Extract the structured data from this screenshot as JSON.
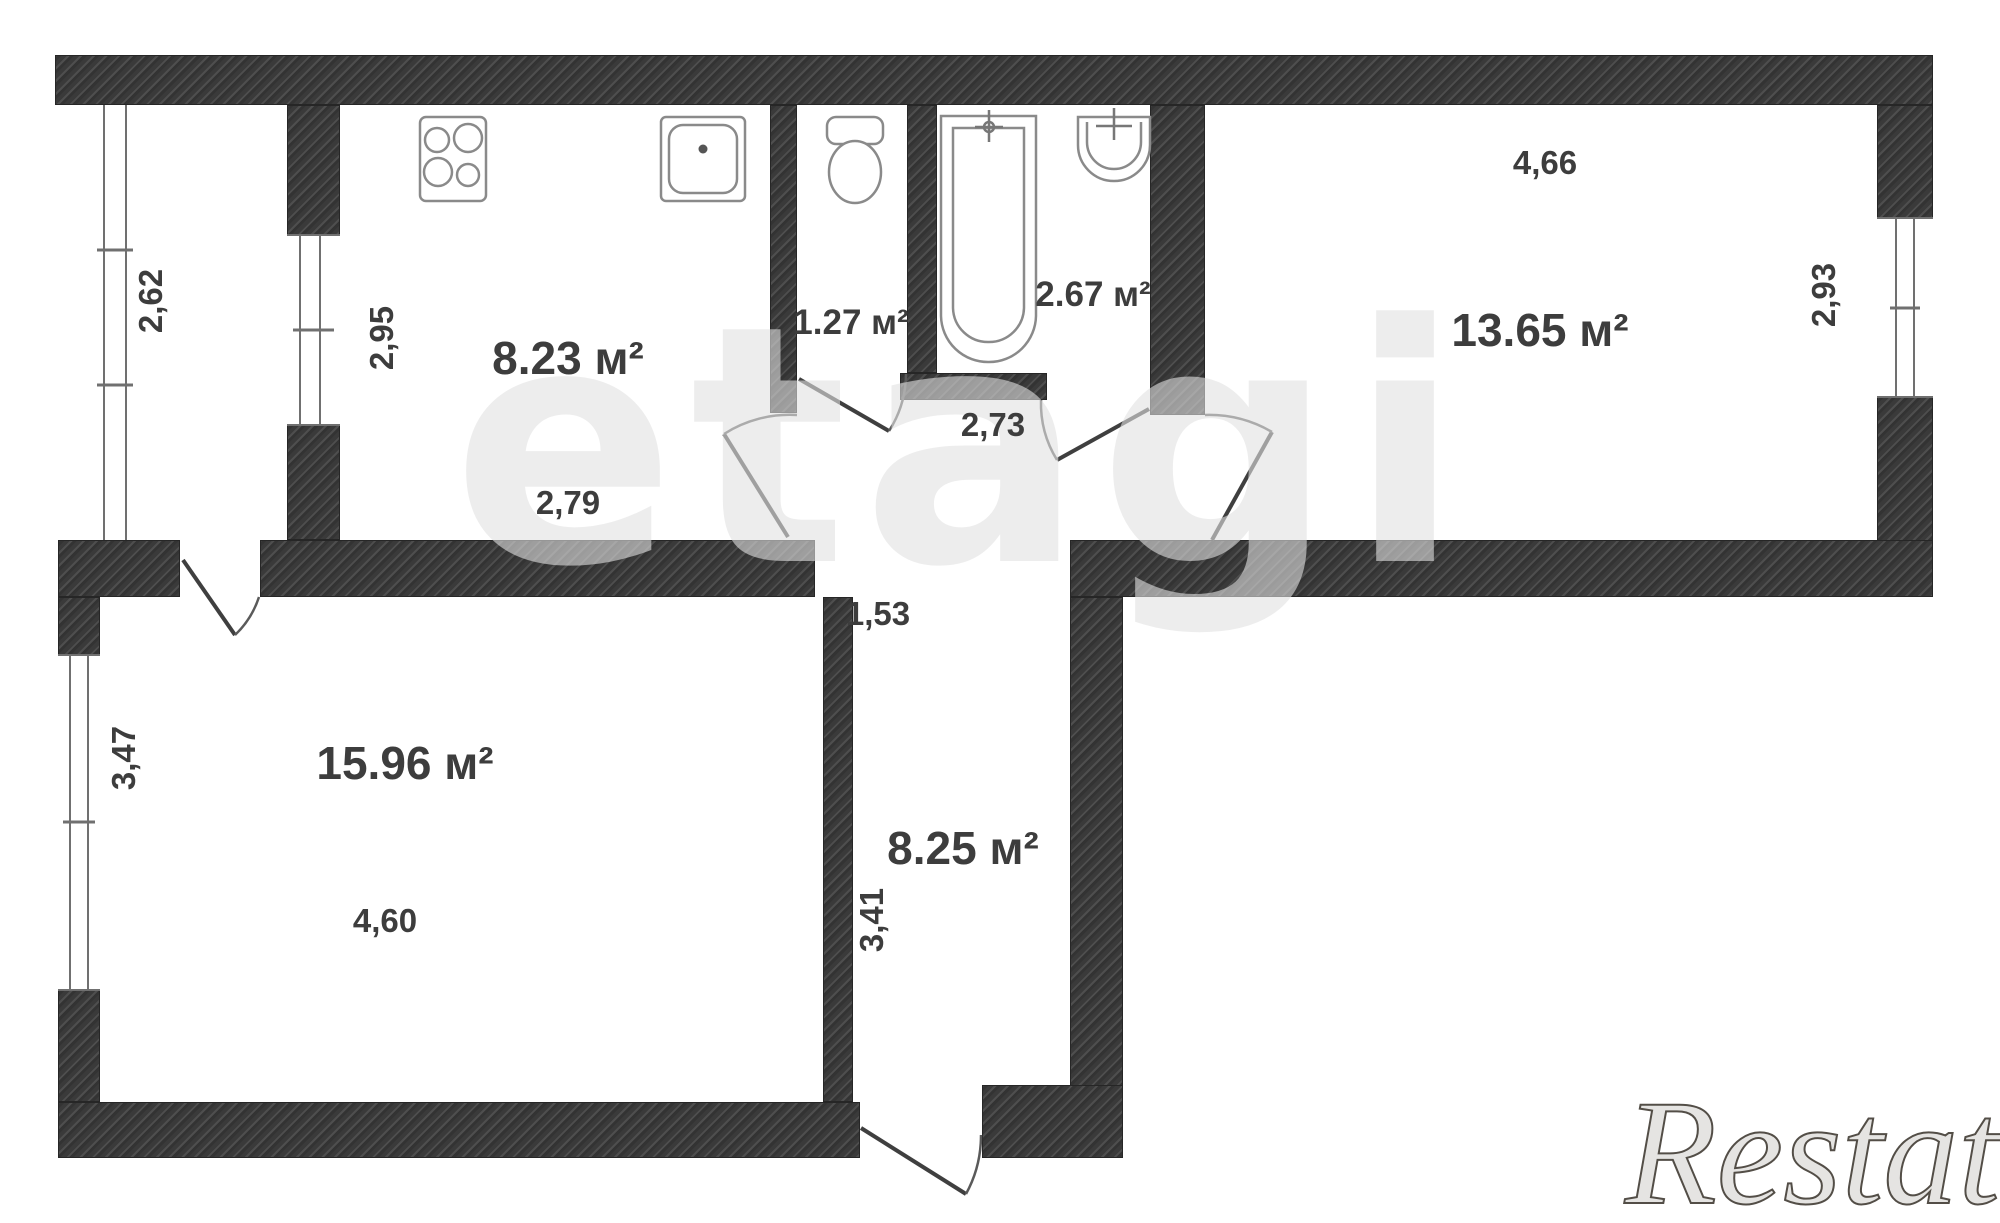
{
  "watermarks": {
    "center": "etagi",
    "corner": "Restate"
  },
  "labels": {
    "balcony_len": "2,62",
    "kitchen_area": "8.23 м²",
    "kitchen_depth": "2,95",
    "kitchen_width": "2,79",
    "wc_area": "1.27 м²",
    "bath_area": "2.67 м²",
    "corridor_width": "2,73",
    "room_right_area": "13.65 м²",
    "room_right_width": "4,66",
    "room_right_depth": "2,93",
    "hall_area": "8.25 м²",
    "hall_opening": "1,53",
    "hall_depth": "3,41",
    "living_area": "15.96 м²",
    "living_depth": "3,47",
    "living_width": "4,60"
  },
  "fixtures": [
    "stove-icon",
    "kitchen-sink-icon",
    "toilet-icon",
    "bathtub-icon",
    "washbasin-icon"
  ]
}
